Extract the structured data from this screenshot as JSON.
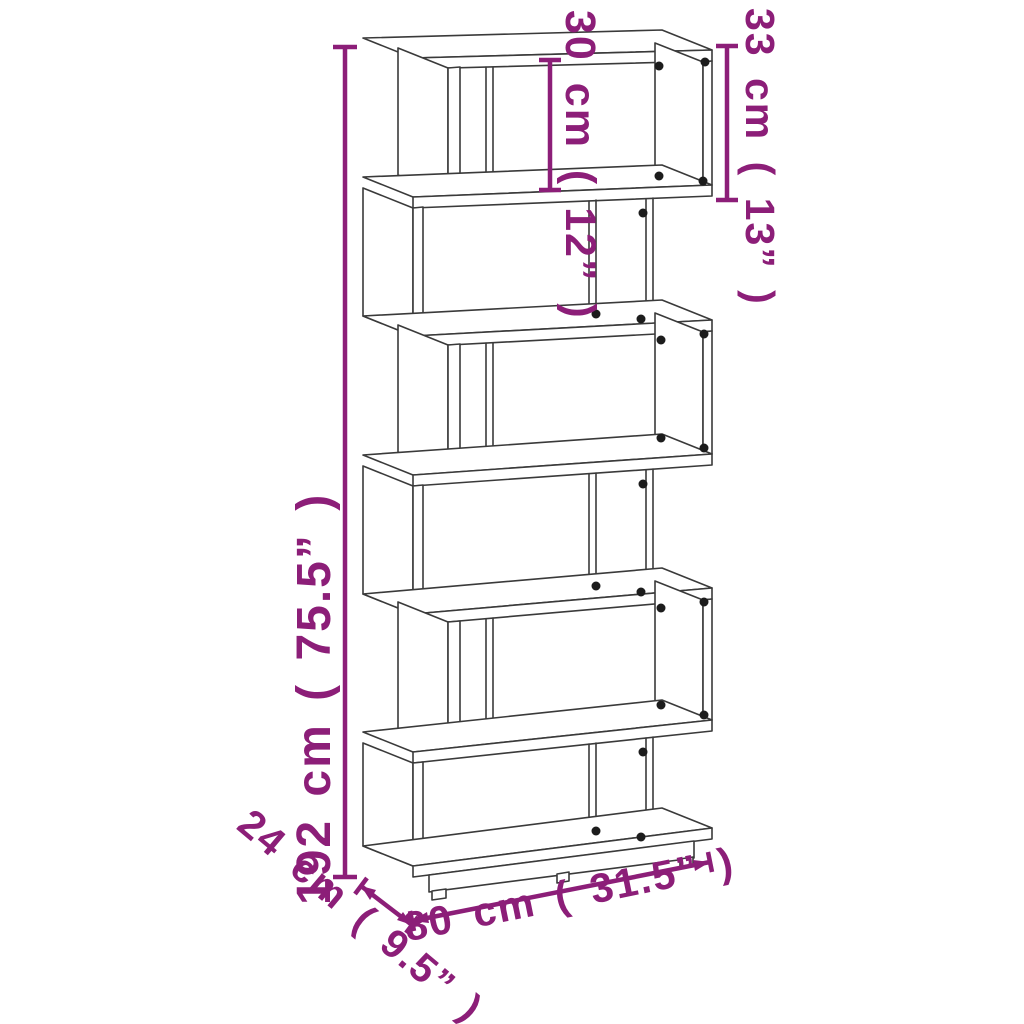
{
  "diagram": {
    "figure_type": "product dimension line drawing",
    "product": "6-tier zigzag bookcase room divider",
    "background": "#ffffff",
    "line_color": "#3a3a3a",
    "dot_color": "#1c1c1c",
    "dimension_color": "#8c1e78",
    "labels": {
      "height": "192 cm ( 75.5” )",
      "inner_height": "30 cm ( 12” )",
      "tier_height": "33 cm ( 13” )",
      "width": "80 cm ( 31.5” )",
      "depth": "24 cm ( 9.5” )"
    }
  }
}
